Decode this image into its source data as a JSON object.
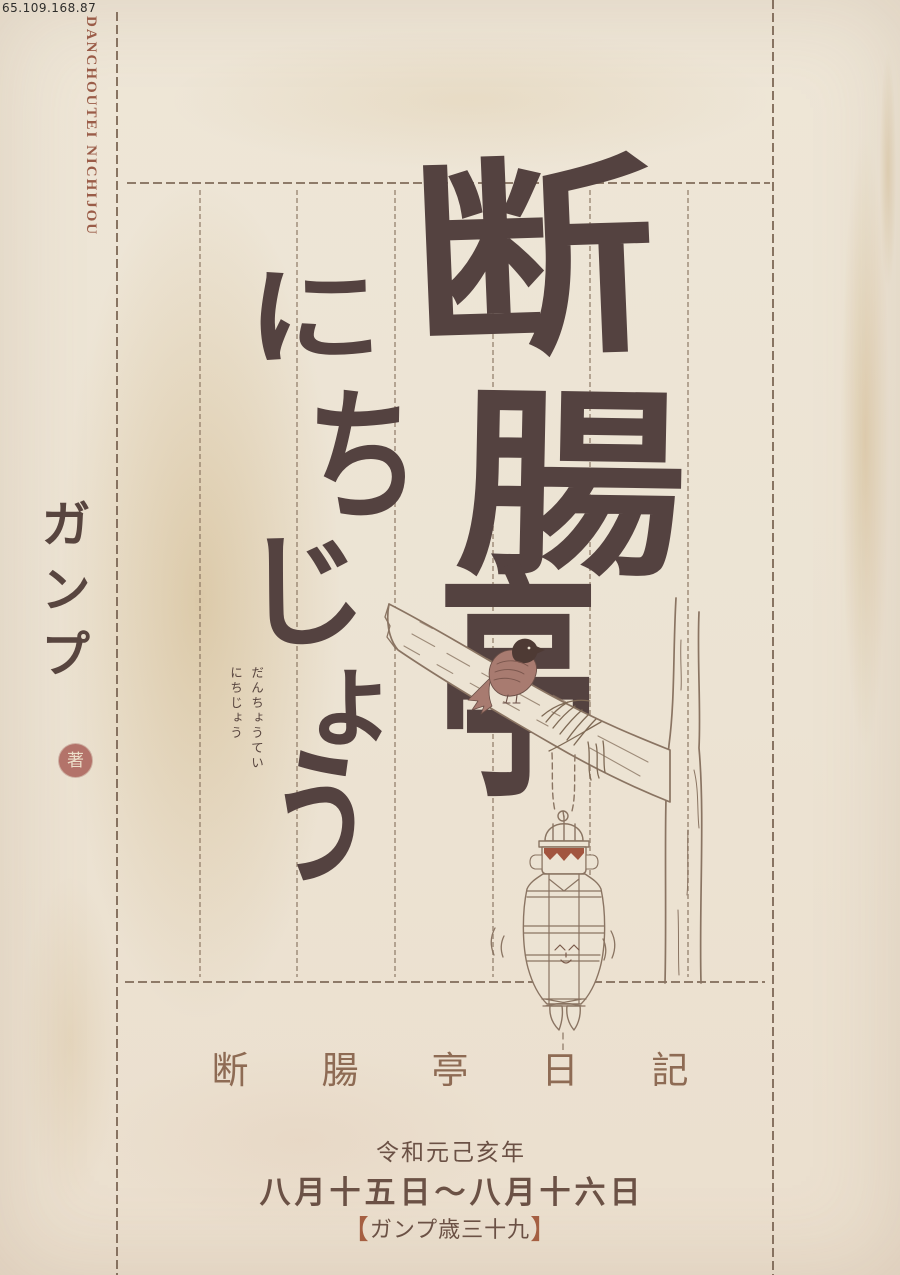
{
  "watermark": "65.109.168.87",
  "spine": {
    "text": "DANCHOUTEI NICHIJOU"
  },
  "author": {
    "name": "ガンプ",
    "seal_label": "著"
  },
  "title": {
    "kanji": [
      {
        "char": "断"
      },
      {
        "char": "腸"
      },
      {
        "char": "亭"
      }
    ],
    "kana": [
      {
        "char": "に"
      },
      {
        "char": "ち"
      },
      {
        "char": "じ"
      },
      {
        "char": "ょ"
      },
      {
        "char": "う"
      }
    ],
    "furigana_right": "だんちょうてい",
    "furigana_left": "にちじょう"
  },
  "footer": {
    "series_title": "断腸亭日記",
    "era_line": "令和元己亥年",
    "date_line": "八月十五日〜八月十六日",
    "age_bracket_open": "【",
    "age_text": "ガンプ歳三十九",
    "age_bracket_close": "】"
  },
  "colors": {
    "paper": "#ece3d3",
    "ink": "#544240",
    "frame_line": "#846e5a",
    "spine_red": "#9a5c48",
    "seal_red": "#b3736a",
    "series_brown": "#8e6b54",
    "footer_dark": "#6b5145",
    "bracket_accent": "#a55f42",
    "illustration_line": "#8a7462",
    "bird_body": "#a87b70",
    "bird_head": "#4e3a34",
    "doll_hair": "#a2553f"
  }
}
